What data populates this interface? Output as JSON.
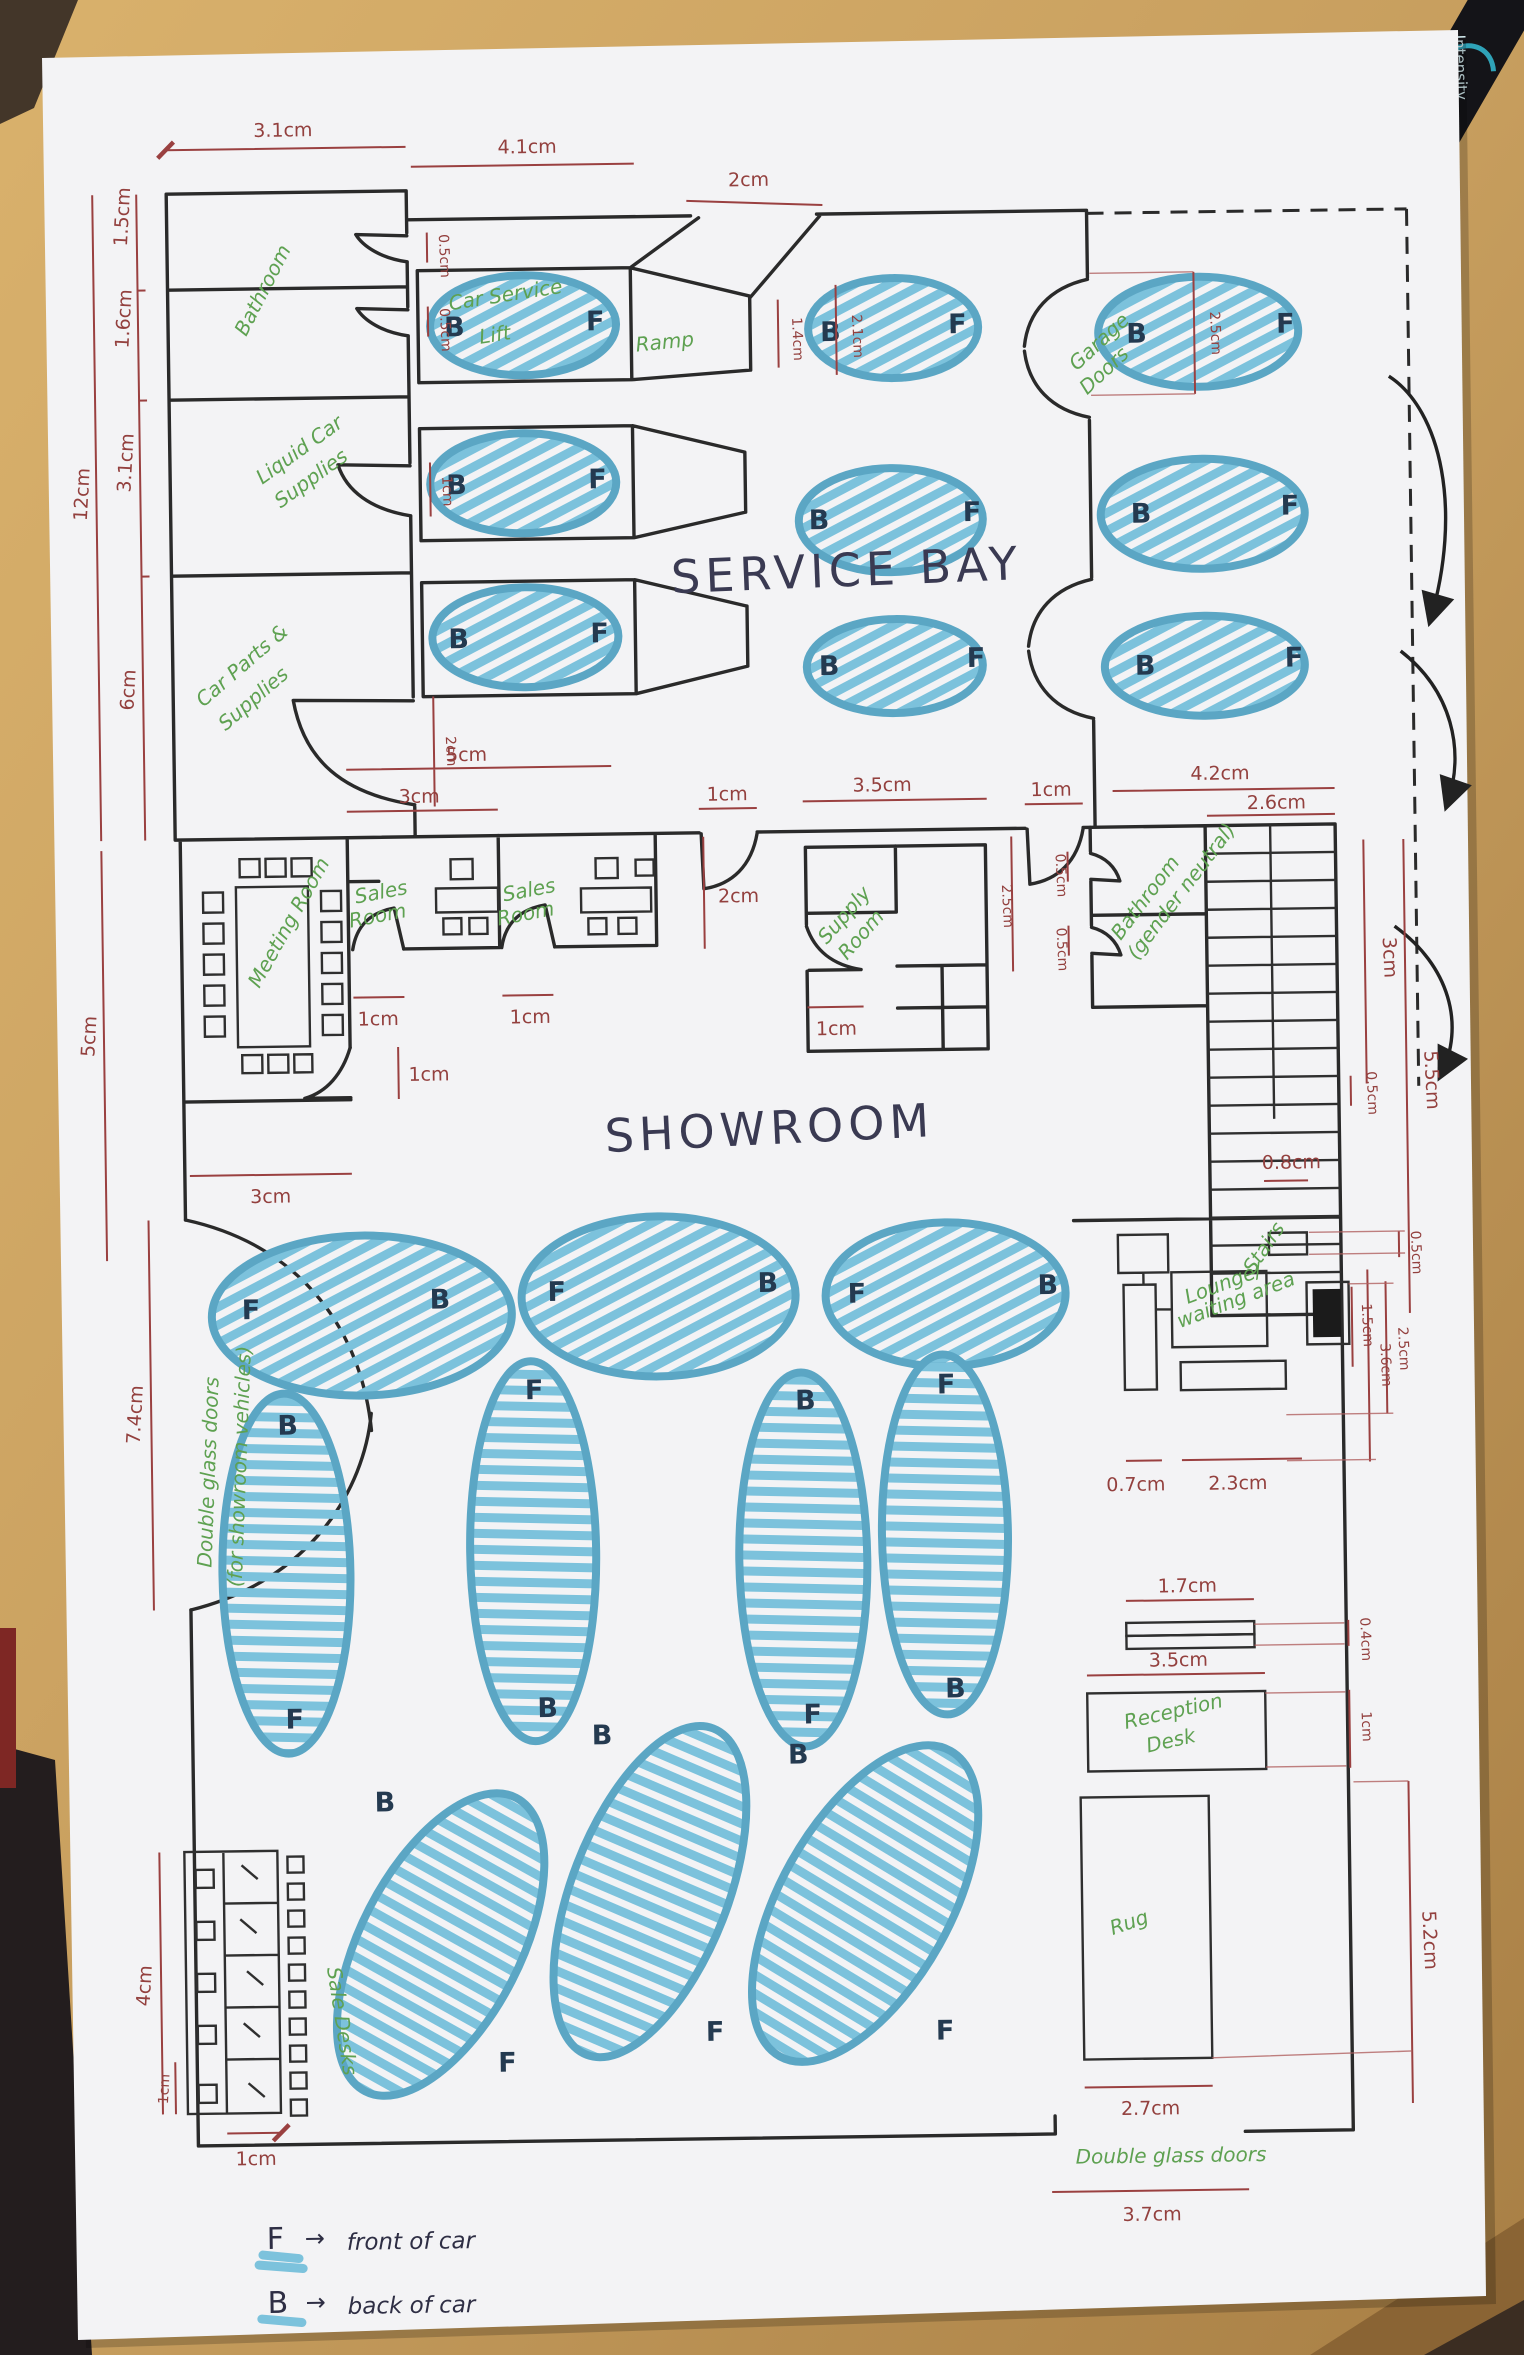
{
  "areas": {
    "service_bay": "SERVICE BAY",
    "showroom": "SHOWROOM"
  },
  "rooms": {
    "bathroom": "Bathroom",
    "liquid1": "Liquid Car",
    "liquid2": "Supplies",
    "parts1": "Car Parts &",
    "parts2": "Supplies",
    "lift1": "Car Service",
    "lift2": "Lift",
    "ramp": "Ramp",
    "garage1": "Garage",
    "garage2": "Doors",
    "meeting": "Meeting Room",
    "sales_line1": "Sales",
    "sales_line2": "Room",
    "supply1": "Supply",
    "supply2": "Room",
    "bath_gn1": "Bathroom",
    "bath_gn2": "(gender neutral)",
    "stairs": "Stairs",
    "lounge1": "Lounge/",
    "lounge2": "waiting area",
    "reception1": "Reception",
    "reception2": "Desk",
    "rug": "Rug",
    "sale_desks": "Sale Desks",
    "dgd": "Double glass doors",
    "dgd_note": "(for showroom vehicles)"
  },
  "dims": {
    "cm04": "0.4cm",
    "cm05": "0.5cm",
    "cm07": "0.7cm",
    "cm08": "0.8cm",
    "cm1": "1cm",
    "cm14": "1.4cm",
    "cm15": "1.5cm",
    "cm16": "1.6cm",
    "cm17": "1.7cm",
    "cm2": "2cm",
    "cm21": "2.1cm",
    "cm23": "2.3cm",
    "cm25": "2.5cm",
    "cm26": "2.6cm",
    "cm27": "2.7cm",
    "cm3": "3cm",
    "cm31": "3.1cm",
    "cm35": "3.5cm",
    "cm36": "3.6cm",
    "cm37": "3.7cm",
    "cm4": "4cm",
    "cm41": "4.1cm",
    "cm42": "4.2cm",
    "cm5": "5cm",
    "cm52": "5.2cm",
    "cm55": "5.5cm",
    "cm6": "6cm",
    "cm74": "7.4cm",
    "cm12": "12cm"
  },
  "cars": {
    "front": "F",
    "back": "B"
  },
  "legend": {
    "front_key": "F",
    "front_text": "front of car",
    "back_key": "B",
    "back_text": "back of car",
    "arrow": "→"
  },
  "stationery": {
    "pen_brand": "Intensity"
  },
  "colors": {
    "wall": "#2a2a2a",
    "dimension": "#9a4040",
    "room_label": "#5ea151",
    "car_fill": "#7cc2dc",
    "car_outline": "#5ba6c4",
    "ink": "#32324a",
    "paper": "#f3f3f5",
    "desk_wood": "#c79e5e"
  }
}
